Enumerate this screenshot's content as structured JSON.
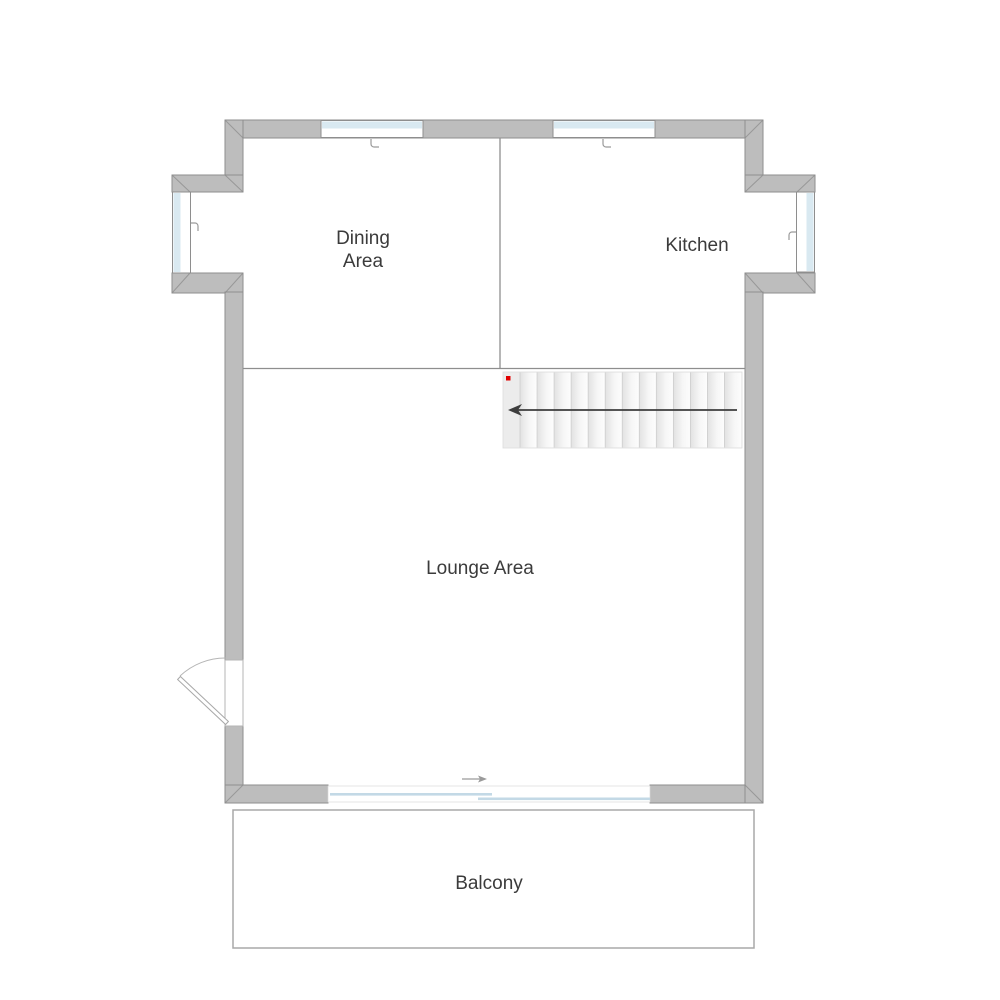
{
  "plan": {
    "type": "floor-plan",
    "rooms": {
      "dining": {
        "label_line1": "Dining",
        "label_line2": "Area"
      },
      "kitchen": {
        "label": "Kitchen"
      },
      "lounge": {
        "label": "Lounge Area"
      },
      "balcony": {
        "label": "Balcony"
      }
    },
    "stairs": {
      "steps": 13,
      "arrow_direction": "left",
      "start_marker": "red-dot"
    },
    "features": {
      "windows": [
        "dining-top-window",
        "kitchen-top-window",
        "dining-bay-window-left",
        "kitchen-bay-window-right"
      ],
      "doors": [
        "entry-door-left-swing",
        "sliding-door-to-balcony"
      ]
    }
  },
  "colors": {
    "bg": "#ffffff",
    "wall": "#bdbdbd",
    "wall-stroke": "#8e8e8e",
    "glass": "#d9e9f1",
    "panel": "#c3d9e6",
    "text": "#3b3b3b",
    "arrow": "#3d3d3d",
    "marker": "#e10000",
    "balcony-stroke": "#a8a8a8"
  }
}
